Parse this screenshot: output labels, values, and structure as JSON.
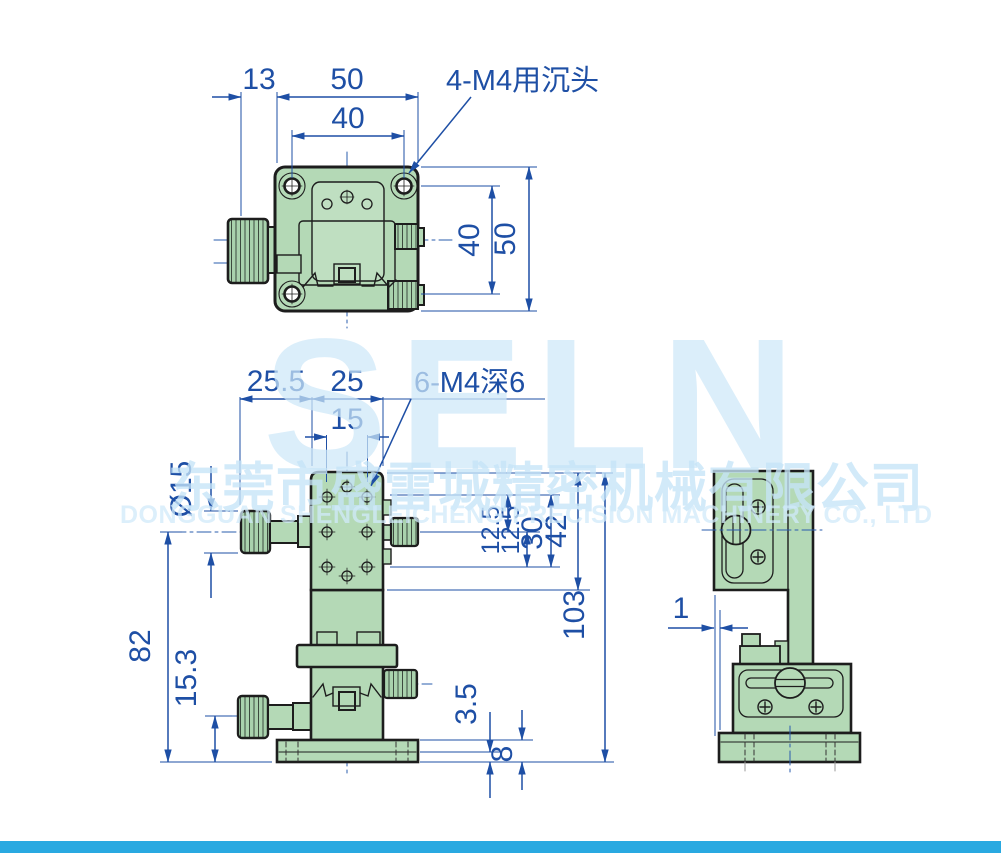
{
  "title": "SELN stage technical drawing",
  "dims": {
    "top": {
      "knob_offset": "13",
      "width_overall": "50",
      "width_holes": "40",
      "height_holes": "40",
      "height_overall": "50",
      "note": "4-M4用沉头"
    },
    "front": {
      "left_offset": "25.5",
      "body_width": "25",
      "hole_span": "15",
      "note": "6-M4深6",
      "knob_dia": "Ø15",
      "height_axis": "82",
      "knob_height": "15.3",
      "row_a": "12.5",
      "row_b": "12.5",
      "rows_span": "30",
      "block_height": "42",
      "total_height": "103",
      "flange_step": "3.5",
      "flange_height": "8"
    },
    "side": {
      "plate_offset": "1"
    }
  },
  "watermark": {
    "logo": "SELN",
    "company_cn": "东莞市盛雷城精密机械有限公司",
    "company_en": "DONGGUAN SHENGLEICHENG PRECISION MACHINERY CO., LTD"
  },
  "colors": {
    "dimension_blue": "#1e4fa5",
    "body_green": "#b4d9b6",
    "outline": "#1d1d1d",
    "watermark_blue": "#d6ecf9",
    "footer_bar": "#29a9e1"
  }
}
